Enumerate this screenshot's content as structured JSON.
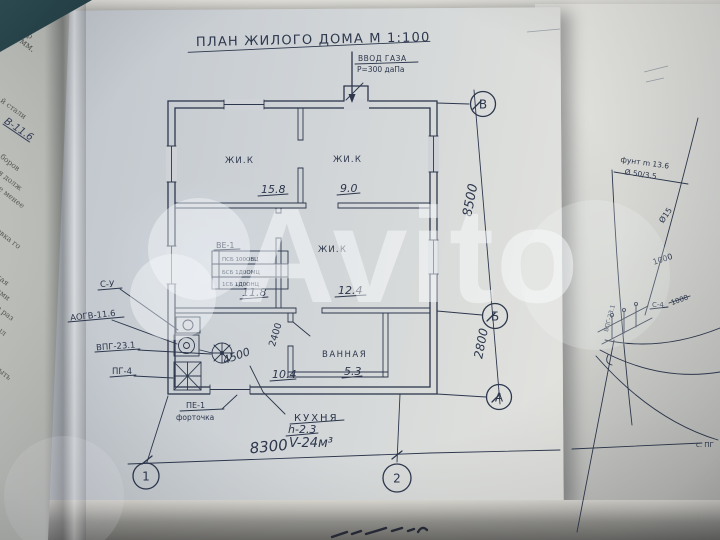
{
  "title": "ПЛАН ЖИЛОГО ДОМА М 1:100",
  "gas_inlet": {
    "line1": "ВВОД ГАЗА",
    "line2": "Р=300 даПа"
  },
  "rooms": {
    "living1": {
      "label": "ЖИ.К",
      "area": "15.8"
    },
    "living2": {
      "label": "ЖИ.К",
      "area": "9.0"
    },
    "living3": {
      "label": "ЖИ.К",
      "area": "12.4"
    },
    "vent": {
      "label": "ВЕ-1",
      "area": "11.8",
      "stamp_rows": [
        "ПСБ 100ОВЦ",
        "БСБ 1Д0ОМЦ",
        "1СБ 1Д0ОНЦ"
      ]
    },
    "bath": {
      "label": "ВАННАЯ",
      "area": "5.3"
    },
    "kitchen_area": "10.4"
  },
  "kitchen_note": {
    "label": "КУХНЯ",
    "height": "h-2.3",
    "volume": "V-24м³"
  },
  "equipment": {
    "su": "С-У",
    "aogv": "АОГВ-11.6",
    "vpg": "ВПГ-23.1",
    "pg": "ПГ-4"
  },
  "window_note": {
    "line1": "ПЕ-1",
    "line2": "форточка"
  },
  "dims": {
    "bottom": "8300",
    "right_top": "8500",
    "right_bottom": "2800",
    "inner_w": "4500",
    "inner_d": "2400"
  },
  "axes": {
    "v_top": "В",
    "v_mid": "Б",
    "v_bottom": "А",
    "h_left": "1",
    "h_right": "2"
  },
  "right_sheet": {
    "note_line1": "фунт m 13.6",
    "note_line2": "Ø 50/3.5",
    "dia_label": "Ø15",
    "dim_a": "1000",
    "dim_b": "1000",
    "su_label": "С-4",
    "riser_label": "ВПГ-23.1",
    "corner_fragment": "с. ПГ"
  },
  "left_page_fragments": [
    "нилые чер",
    "250мм.",
    "й стали",
    "В-11.6",
    "боров",
    "я долж",
    "е менее",
    "овка го",
    "кая",
    "ами",
    "о раз",
    "ыл",
    "ыть"
  ],
  "watermark": "Avito",
  "colors": {
    "ink": "#2d374d",
    "paper": "#cdd2d6",
    "table": "#26454b",
    "watermark": "rgba(250,251,253,0.5)"
  }
}
